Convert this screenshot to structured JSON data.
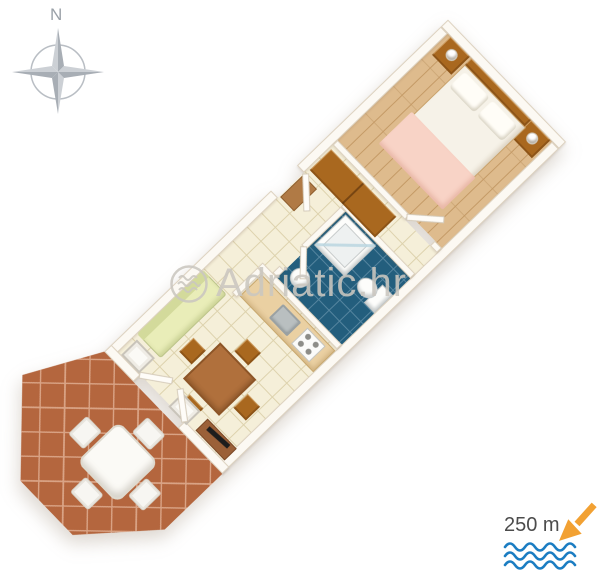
{
  "image": {
    "type": "3d-apartment-floor-plan-rendering",
    "background": "#ffffff"
  },
  "compass": {
    "label": "N"
  },
  "watermark": {
    "logo": "waves-circle-logo",
    "text": "Adriatic.hr"
  },
  "distance_indicator": {
    "label": "250 m",
    "arrow_icon": "arrow-down-left-icon",
    "waves_icon": "sea-waves-icon"
  },
  "floor_plan": {
    "rotation_deg": 46,
    "rooms": [
      {
        "name": "bedroom",
        "floor": "light-wood-planks"
      },
      {
        "name": "hallway",
        "floor": "cream-ceramic-tile"
      },
      {
        "name": "bathroom",
        "floor": "blue-ceramic-tile"
      },
      {
        "name": "kitchenette",
        "floor": "cream-ceramic-tile"
      },
      {
        "name": "living-dining-room",
        "floor": "cream-ceramic-tile"
      },
      {
        "name": "terrace",
        "floor": "terracotta-tile"
      }
    ],
    "furniture": {
      "bedroom": [
        "double-bed-white-duvet-pink-blanket",
        "two-pillows",
        "wood-headboard",
        "nightstand-left-with-lamp",
        "nightstand-right-with-lamp"
      ],
      "hallway": [
        "wardrobe",
        "entry-doormat"
      ],
      "bathroom": [
        "corner-shower-cabin",
        "toilet",
        "washbasin"
      ],
      "kitchenette": [
        "counter",
        "sink",
        "stove-4-burners"
      ],
      "living_room": [
        "sofa-pale-green",
        "dining-table",
        "four-chairs",
        "tv-stand-with-tv",
        "two-white-frame-chairs"
      ],
      "terrace": [
        "white-table",
        "four-white-chairs"
      ]
    }
  },
  "colors": {
    "wall_fill": "#fcf9f3",
    "wall_edge": "#ddd2c0",
    "bedroom_floor": "#debb8d",
    "bedroom_floor_line": "#c49a66",
    "tile_floor": "#f5efd9",
    "tile_line": "#ddd2ad",
    "bath_floor": "#235e7d",
    "bath_line": "#55859f",
    "terrace_floor": "#b4663e",
    "terrace_line": "#d9a385",
    "wood_dark": "#a9681f",
    "sofa": "#e9edb8",
    "sofa_dark": "#d3da9b",
    "counter": "#ead0a2",
    "bed_white": "#f6f2e8",
    "blanket_pink": "#f8d3c6",
    "tv_brown": "#9b6038",
    "watermark": "#cbc7c0",
    "compass_gray": "#9aa1a8",
    "distance_text": "#4c4c4c",
    "arrow_orange": "#f2a133",
    "waves_blue": "#1b7dc2"
  }
}
